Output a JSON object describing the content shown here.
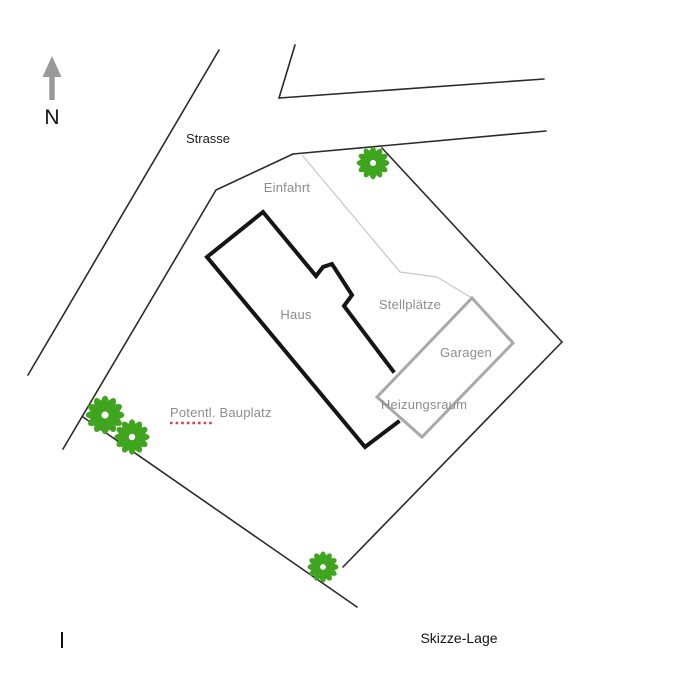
{
  "title": "Skizze-Lage",
  "north": {
    "letter": "N"
  },
  "labels": {
    "strasse": "Strasse",
    "einfahrt": "Einfahrt",
    "haus": "Haus",
    "stellplaetze": "Stellplätze",
    "garagen": "Garagen",
    "heizungsraum": "Heizungsraum",
    "potentl_bauplatz": "Potentl. Bauplatz",
    "skizze_lage": "Skizze-Lage"
  },
  "icons": {
    "north_arrow": "north-arrow-icon (gray up arrow)",
    "tree": "tree-icon (green 12-petal flower with white center)"
  },
  "colors": {
    "tree_green": "#3fa41e",
    "label_gray": "#8c8c8c",
    "garage_gray": "#a9a9a9",
    "path_gray": "#c9c9c9",
    "line_black": "#2a2a2a",
    "house_black": "#151515",
    "arrow_gray": "#999999",
    "underline_red": "#d94040"
  }
}
